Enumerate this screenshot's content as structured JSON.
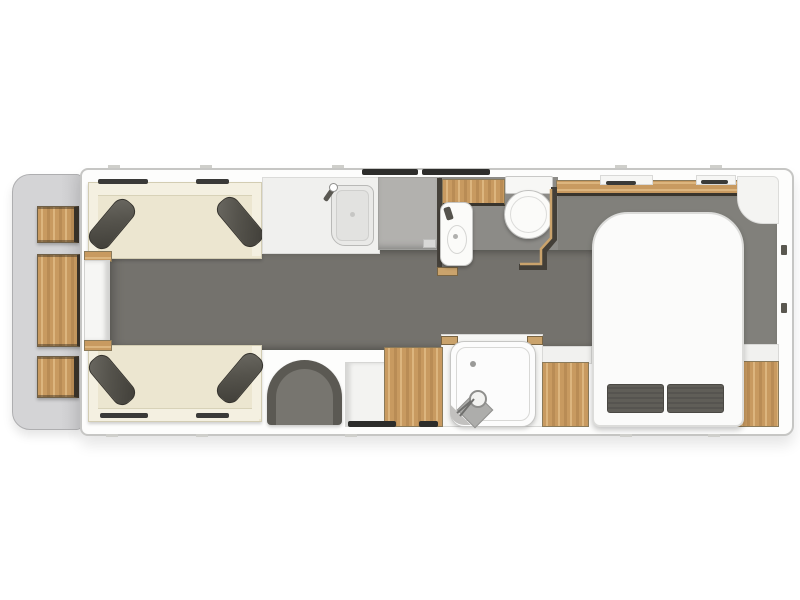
{
  "meta": {
    "description": "Top-down 3D floor plan of a single-axle caravan, front lounge to rear island-bed layout",
    "canvas_width": 800,
    "canvas_height": 600
  },
  "colors": {
    "background": "#ffffff",
    "body_wall": "#fdfdfc",
    "front_locker": "#d4d4d6",
    "wood_a": "#c89a60",
    "wood_b": "#dcb57e",
    "wood_c": "#b98c55",
    "sofa": "#ece6d0",
    "sofa_trim": "#f4f0e1",
    "cushion": "#55534c",
    "floor_walkway": "#74726d",
    "floor_room": "#81807b",
    "floor_bath": "#8c8b87",
    "counter": "#f0f0ee",
    "worktop": "#b2b1ae",
    "wall_dark": "#46423b",
    "wall_tan": "#caa36c",
    "pillow": "#605e58",
    "window_slit": "#3a3a38",
    "tick": "#cfcfcb"
  },
  "floorplan": {
    "front_storage": {
      "name": "front gas locker",
      "shelf_count": 3
    },
    "lounge": {
      "items": [
        "offside sofa",
        "nearside sofa",
        "front chest",
        "scatter cushions x4"
      ]
    },
    "kitchen": {
      "items": [
        "sink with tap",
        "worktop",
        "base cabinet",
        "side cabinet"
      ]
    },
    "washroom": {
      "items": [
        "overhead locker",
        "washbasin",
        "toilet",
        "shower cubicle"
      ]
    },
    "bedroom": {
      "items": [
        "island bed",
        "pillows x2",
        "foot wardrobe left",
        "foot wardrobe right",
        "head shelf",
        "corner unit",
        "lounge chair"
      ]
    },
    "openings": {
      "top_windows": 2,
      "rooflights": 2,
      "bottom_windows": 2,
      "entrance_door": 1
    }
  }
}
